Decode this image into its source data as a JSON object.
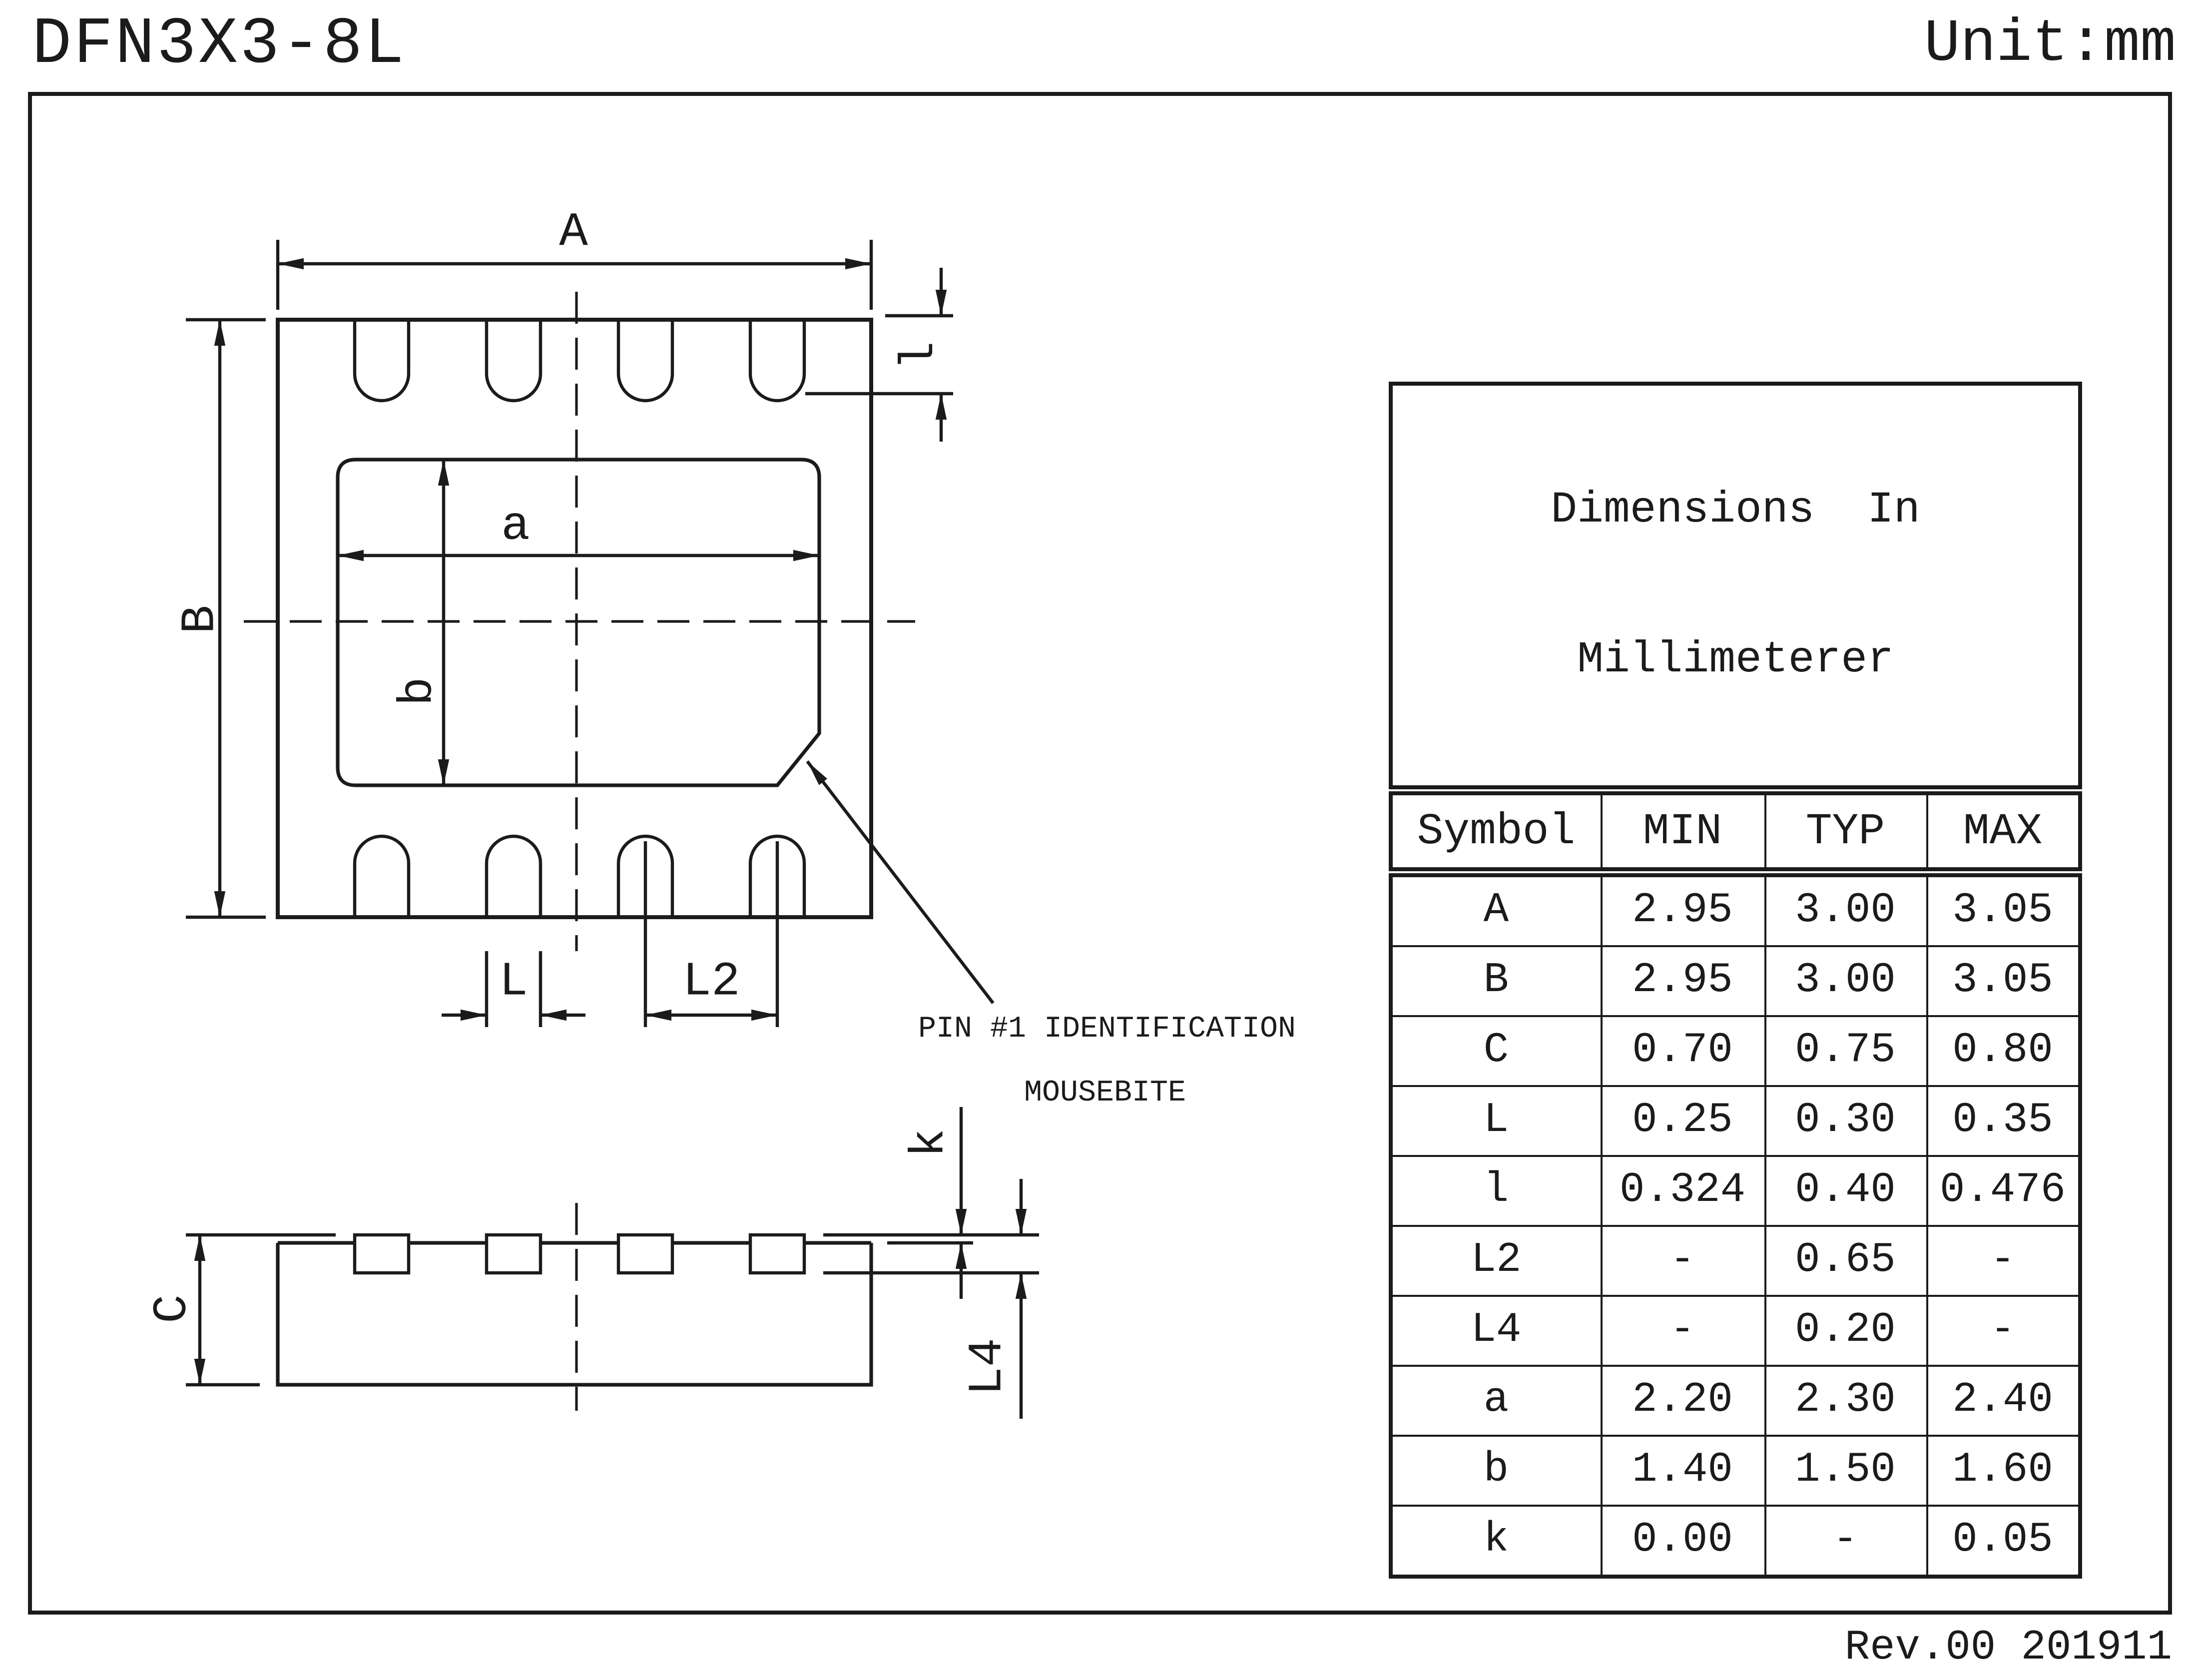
{
  "header": {
    "title": "DFN3X3-8L",
    "unit": "Unit:mm"
  },
  "footer": {
    "revision": "Rev.00 201911"
  },
  "colors": {
    "ink": "#1b1b1b",
    "paper": "#ffffff"
  },
  "drawing": {
    "labels": {
      "A": "A",
      "B": "B",
      "a": "a",
      "b": "b",
      "l": "l",
      "L": "L",
      "L2": "L2",
      "C": "C",
      "k": "k",
      "L4": "L4"
    },
    "annotation": {
      "line1": "PIN #1 IDENTIFICATION",
      "line2": "MOUSEBITE"
    }
  },
  "table": {
    "title_line1": "Dimensions  In",
    "title_line2": "Millimeterer",
    "columns": [
      "Symbol",
      "MIN",
      "TYP",
      "MAX"
    ],
    "rows": [
      {
        "symbol": "A",
        "min": "2.95",
        "typ": "3.00",
        "max": "3.05"
      },
      {
        "symbol": "B",
        "min": "2.95",
        "typ": "3.00",
        "max": "3.05"
      },
      {
        "symbol": "C",
        "min": "0.70",
        "typ": "0.75",
        "max": "0.80"
      },
      {
        "symbol": "L",
        "min": "0.25",
        "typ": "0.30",
        "max": "0.35"
      },
      {
        "symbol": "l",
        "min": "0.324",
        "typ": "0.40",
        "max": "0.476"
      },
      {
        "symbol": "L2",
        "min": "-",
        "typ": "0.65",
        "max": "-"
      },
      {
        "symbol": "L4",
        "min": "-",
        "typ": "0.20",
        "max": "-"
      },
      {
        "symbol": "a",
        "min": "2.20",
        "typ": "2.30",
        "max": "2.40"
      },
      {
        "symbol": "b",
        "min": "1.40",
        "typ": "1.50",
        "max": "1.60"
      },
      {
        "symbol": "k",
        "min": "0.00",
        "typ": "-",
        "max": "0.05"
      }
    ]
  }
}
